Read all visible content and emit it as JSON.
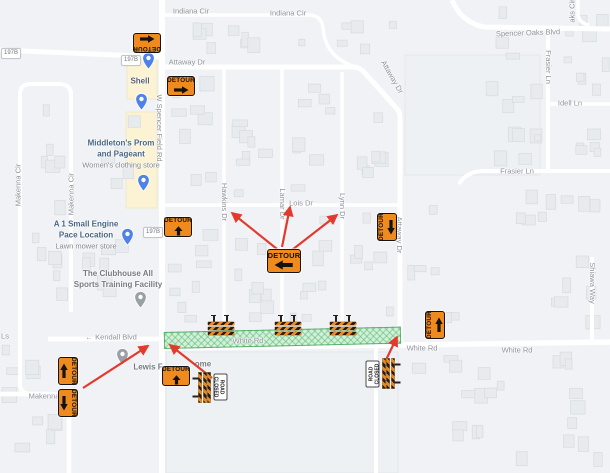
{
  "sign_text": "DETOUR",
  "road_closed_text": [
    "ROAD",
    "CLOSED"
  ],
  "colors": {
    "detour_orange": "#ee8a1e",
    "arrow_red": "#e23b2e",
    "closure_green": "#56be6c",
    "map_background": "#f0f2f5",
    "road": "#ffffff",
    "street_label": "#8d9398",
    "poi_blue": "#4a6585",
    "poi_gray": "#757b82"
  },
  "street_labels": [
    {
      "text": "Indiana Cir",
      "x": 191,
      "y": 11,
      "rot": 0
    },
    {
      "text": "Indiana Cir",
      "x": 288,
      "y": 13,
      "rot": 0
    },
    {
      "text": "Attaway Dr",
      "x": 187,
      "y": 62,
      "rot": 0
    },
    {
      "text": "Attaway Dr",
      "x": 392,
      "y": 77,
      "rot": 60
    },
    {
      "text": "Attaway Dr",
      "x": 399,
      "y": 235,
      "rot": 90
    },
    {
      "text": "Spencer Oaks Blvd",
      "x": 528,
      "y": 33,
      "rot": -2
    },
    {
      "text": "aks Cir",
      "x": 572,
      "y": 11,
      "rot": -90
    },
    {
      "text": "Frasier Ln",
      "x": 548,
      "y": 67,
      "rot": 90
    },
    {
      "text": "Idell Ln",
      "x": 570,
      "y": 103,
      "rot": 0
    },
    {
      "text": "Frasier Ln",
      "x": 517,
      "y": 171,
      "rot": 0
    },
    {
      "text": "W Spencer Field Rd",
      "x": 159,
      "y": 128,
      "rot": 90
    },
    {
      "text": "Hawkins Dr",
      "x": 224,
      "y": 202,
      "rot": 90
    },
    {
      "text": "Lamar Dr",
      "x": 282,
      "y": 204,
      "rot": 90
    },
    {
      "text": "Lois Dr",
      "x": 301,
      "y": 203,
      "rot": 0
    },
    {
      "text": "Lynn Dr",
      "x": 342,
      "y": 206,
      "rot": 90
    },
    {
      "text": "Makenna Cir",
      "x": 18,
      "y": 185,
      "rot": -90
    },
    {
      "text": "Makenna Cir",
      "x": 71,
      "y": 194,
      "rot": -90
    },
    {
      "text": "Makenna",
      "x": 44,
      "y": 396,
      "rot": 0
    },
    {
      "text": "Ls",
      "x": 5,
      "y": 336,
      "rot": 0
    },
    {
      "text": "Kendall Blvd",
      "x": 116,
      "y": 337,
      "rot": 0
    },
    {
      "text": "←",
      "x": 89,
      "y": 337,
      "rot": 0
    },
    {
      "text": "→",
      "x": 146,
      "y": 344,
      "rot": 0
    },
    {
      "text": "White Rd",
      "x": 248,
      "y": 341,
      "rot": -1
    },
    {
      "text": "White Rd",
      "x": 422,
      "y": 348,
      "rot": 0
    },
    {
      "text": "White Rd",
      "x": 517,
      "y": 350,
      "rot": 0
    },
    {
      "text": "Dean Dr",
      "x": 374,
      "y": 374,
      "rot": 90
    },
    {
      "text": "Shiawa Way",
      "x": 592,
      "y": 283,
      "rot": 90
    }
  ],
  "route_shields": [
    {
      "text": "197B",
      "x": 10,
      "y": 52
    },
    {
      "text": "197B",
      "x": 130,
      "y": 59
    },
    {
      "text": "197B",
      "x": 152,
      "y": 231
    }
  ],
  "pois": [
    {
      "lines": [
        "Shell"
      ],
      "sub": "",
      "x": 140,
      "y": 81,
      "color": "#5b6167",
      "pin": {
        "x": 148,
        "y": 61,
        "color": "#4f82e8",
        "type": "fuel-pin"
      }
    },
    {
      "lines": [],
      "sub": "",
      "x": 0,
      "y": 0,
      "color": "#4a6585",
      "pin": {
        "x": 141,
        "y": 102,
        "color": "#4f82e8",
        "type": "shopping-pin"
      }
    },
    {
      "lines": [
        "Middleton's Prom",
        "and Pageant"
      ],
      "sub": "Women's clothing store",
      "x": 121,
      "y": 154,
      "color": "#4a6585",
      "pin": {
        "x": 143,
        "y": 183,
        "color": "#4f82e8",
        "type": "shopping-pin"
      }
    },
    {
      "lines": [
        "A 1 Small Engine",
        "Pace Location"
      ],
      "sub": "Lawn mower store",
      "x": 86,
      "y": 235,
      "color": "#4a6585",
      "pin": {
        "x": 127,
        "y": 237,
        "color": "#4f82e8",
        "type": "shopping-pin"
      }
    },
    {
      "lines": [
        "The Clubhouse All",
        "Sports Training Facility"
      ],
      "sub": "",
      "x": 118,
      "y": 279,
      "color": "#757b82",
      "pin": {
        "x": 140,
        "y": 300,
        "color": "#99a0a6",
        "type": "generic-pin"
      }
    },
    {
      "lines": [
        "Lewis F"
      ],
      "sub": "",
      "x": 148,
      "y": 367,
      "color": "#757b82",
      "pin": {
        "x": 122,
        "y": 357,
        "color": "#99a0a6",
        "type": "generic-pin"
      }
    },
    {
      "lines": [
        "ome"
      ],
      "sub": "",
      "x": 203,
      "y": 364,
      "color": "#757b82",
      "pin": null
    }
  ],
  "detour_signs": [
    {
      "x": 147,
      "y": 43,
      "rot": 180,
      "dir": "left",
      "big": false
    },
    {
      "x": 181,
      "y": 86,
      "rot": 0,
      "dir": "right",
      "big": false
    },
    {
      "x": 178,
      "y": 227,
      "rot": 0,
      "dir": "up",
      "big": false
    },
    {
      "x": 284,
      "y": 261,
      "rot": 0,
      "dir": "left",
      "big": true
    },
    {
      "x": 387,
      "y": 227,
      "rot": -90,
      "dir": "left",
      "big": false
    },
    {
      "x": 68,
      "y": 371,
      "rot": 90,
      "dir": "left",
      "big": false
    },
    {
      "x": 68,
      "y": 403,
      "rot": 90,
      "dir": "right",
      "big": false
    },
    {
      "x": 176,
      "y": 376,
      "rot": 0,
      "dir": "up",
      "big": false
    },
    {
      "x": 435,
      "y": 325,
      "rot": -90,
      "dir": "right",
      "big": false
    }
  ],
  "road_closed_assemblies": [
    {
      "x": 210,
      "y": 387,
      "rot": 90
    },
    {
      "x": 383,
      "y": 373,
      "rot": -90
    }
  ],
  "barricades": [
    {
      "x": 221,
      "y": 327
    },
    {
      "x": 288,
      "y": 327
    },
    {
      "x": 343,
      "y": 327
    }
  ],
  "closure_band": {
    "x": 164,
    "y": 332,
    "w": 237,
    "h": 17,
    "rot": -1.3
  },
  "red_arrows": [
    {
      "x1": 277,
      "y1": 249,
      "x2": 232,
      "y2": 213
    },
    {
      "x1": 282,
      "y1": 247,
      "x2": 290,
      "y2": 207
    },
    {
      "x1": 292,
      "y1": 250,
      "x2": 337,
      "y2": 215
    },
    {
      "x1": 83,
      "y1": 388,
      "x2": 148,
      "y2": 346
    },
    {
      "x1": 212,
      "y1": 378,
      "x2": 170,
      "y2": 345
    },
    {
      "x1": 385,
      "y1": 362,
      "x2": 397,
      "y2": 337
    }
  ]
}
